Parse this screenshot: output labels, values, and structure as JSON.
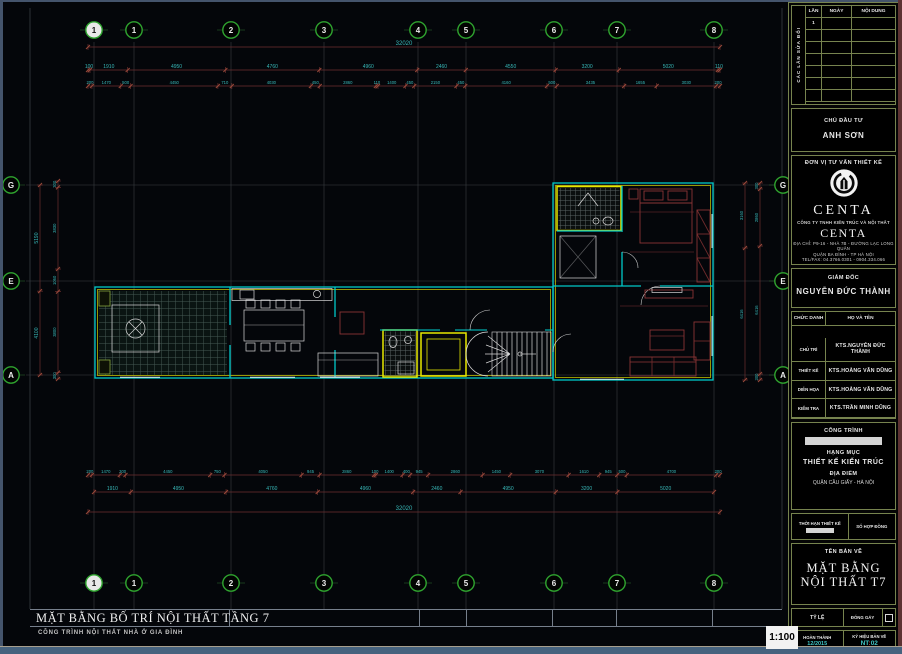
{
  "drawing": {
    "title": "MẶT BẰNG BỐ TRÍ NỘI THẤT TẦNG 7",
    "subtitle": "CÔNG TRÌNH NỘI THẤT NHÀ Ở GIA ĐÌNH",
    "scale_badge": "1:100"
  },
  "grid": {
    "bubble_color": "#2fa32f",
    "cols": [
      {
        "label": "1",
        "x": 94,
        "filled": true
      },
      {
        "label": "1",
        "x": 134
      },
      {
        "label": "2",
        "x": 231
      },
      {
        "label": "3",
        "x": 324
      },
      {
        "label": "4",
        "x": 418
      },
      {
        "label": "5",
        "x": 466
      },
      {
        "label": "6",
        "x": 554
      },
      {
        "label": "7",
        "x": 617
      },
      {
        "label": "8",
        "x": 714
      }
    ],
    "rows": [
      {
        "label": "G",
        "y": 185
      },
      {
        "label": "E",
        "y": 281
      },
      {
        "label": "A",
        "y": 375
      }
    ]
  },
  "dims": {
    "line_color": "#6e2f2f",
    "text_color": "#38b8b8",
    "h_rows": [
      {
        "y": 47,
        "x0": 88,
        "x1": 720,
        "fs": 6,
        "vals": [
          "32020"
        ]
      },
      {
        "y": 70,
        "x0": 88,
        "x1": 720,
        "fs": 5,
        "vals": [
          "100",
          "1910",
          "4950",
          "4760",
          "4960",
          "2460",
          "4550",
          "3200",
          "5020",
          "110"
        ]
      },
      {
        "y": 86,
        "x0": 88,
        "x1": 720,
        "fs": 4.2,
        "vals": [
          "200",
          "1470",
          "500",
          "4450",
          "710",
          "4030",
          "450",
          "2860",
          "110",
          "1400",
          "450",
          "2150",
          "450",
          "4160",
          "500",
          "3435",
          "1655",
          "3030",
          "200"
        ]
      },
      {
        "y": 475,
        "x0": 88,
        "x1": 720,
        "fs": 4.2,
        "vals": [
          "200",
          "1470",
          "300",
          "4450",
          "750",
          "4050",
          "945",
          "2860",
          "100",
          "1400",
          "400",
          "945",
          "2860",
          "1450",
          "3070",
          "1610",
          "945",
          "500",
          "4700",
          "200"
        ]
      },
      {
        "y": 492,
        "x0": 94,
        "x1": 714,
        "fs": 5,
        "vals": [
          "1910",
          "4950",
          "4760",
          "4960",
          "2460",
          "4950",
          "3200",
          "5020"
        ]
      },
      {
        "y": 512,
        "x0": 88,
        "x1": 720,
        "fs": 6,
        "vals": [
          "32020"
        ]
      }
    ],
    "v_rows": [
      {
        "x": 40,
        "y0": 185,
        "y1": 375,
        "fs": 5,
        "vals": [
          "5190",
          "4100"
        ]
      },
      {
        "x": 58,
        "y0": 181,
        "y1": 379,
        "fs": 4.2,
        "vals": [
          "300",
          "3830",
          "1060",
          "3800",
          "300"
        ]
      },
      {
        "x": 745,
        "y0": 183,
        "y1": 380,
        "fs": 4.2,
        "vals": [
          "3160",
          "6416"
        ]
      },
      {
        "x": 760,
        "y0": 183,
        "y1": 380,
        "fs": 4.2,
        "vals": [
          "300",
          "2860",
          "6416",
          "300"
        ]
      }
    ]
  },
  "titleblock": {
    "border_color": "#76834e",
    "revisions": {
      "side_label": "CÁC LẦN SỬA ĐỔI",
      "cols": [
        "LẦN",
        "NGÀY",
        "NỘI DUNG"
      ],
      "first_row_no": "1"
    },
    "owner": {
      "label": "CHỦ ĐẦU TƯ",
      "name": "ANH SƠN"
    },
    "firm": {
      "label": "ĐƠN VỊ TƯ VẤN THIẾT KẾ",
      "brand": "CENTA",
      "company": "CÔNG TY TNHH KIẾN TRÚC VÀ NỘI THẤT",
      "brand2": "CENTA",
      "addr1": "ĐỊA CHỈ: P9-16 - NHÀ 7B - ĐƯỜNG LẠC LONG QUÂN",
      "addr2": "QUẬN BA ĐÌNH - TP HÀ NỘI",
      "addr3": "TEL/FAX: 04.3766.0301 - 0904.334.066",
      "addr4": "EMAIL: CENTADESIGN@GMAIL.COM"
    },
    "director": {
      "label": "GIÁM ĐỐC",
      "name": "NGUYỄN ĐỨC THÀNH"
    },
    "personnel": {
      "head_role": "CHỨC DANH",
      "head_name": "HỌ VÀ TÊN",
      "rows": [
        {
          "role": "CHỦ TRÌ",
          "name": "KTS.NGUYỄN ĐỨC THÀNH"
        },
        {
          "role": "THIẾT KẾ",
          "name": "KTS.HOÀNG VĂN DŨNG"
        },
        {
          "role": "DIỄN HỌA",
          "name": "KTS.HOÀNG VĂN DŨNG"
        },
        {
          "role": "KIỂM TRA",
          "name": "KTS.TRẦN MINH DŨNG"
        }
      ]
    },
    "project": {
      "label": "CÔNG TRÌNH",
      "item_label": "HẠNG MỤC",
      "item": "THIẾT KẾ KIẾN TRÚC",
      "loc_label": "ĐỊA ĐIỂM",
      "loc": "QUẬN CẦU GIẤY - HÀ NỘI"
    },
    "contract": {
      "left": "THỜI HẠN THIẾT KẾ",
      "right": "SỐ HỢP ĐỒNG"
    },
    "sheet": {
      "label": "TÊN BẢN VẼ",
      "name1": "MẶT BẰNG",
      "name2": "NỘI THẤT T7"
    },
    "scale_row": {
      "left": "TỶ LỆ",
      "mid": "ĐÓNG GÁY"
    },
    "footer": {
      "left_label": "HOÀN THÀNH",
      "left_value": "12/2015",
      "right_label": "KÝ HIỆU BẢN VẼ",
      "code_pre": "NT",
      "code_sep": ":",
      "code_num": "02"
    }
  }
}
